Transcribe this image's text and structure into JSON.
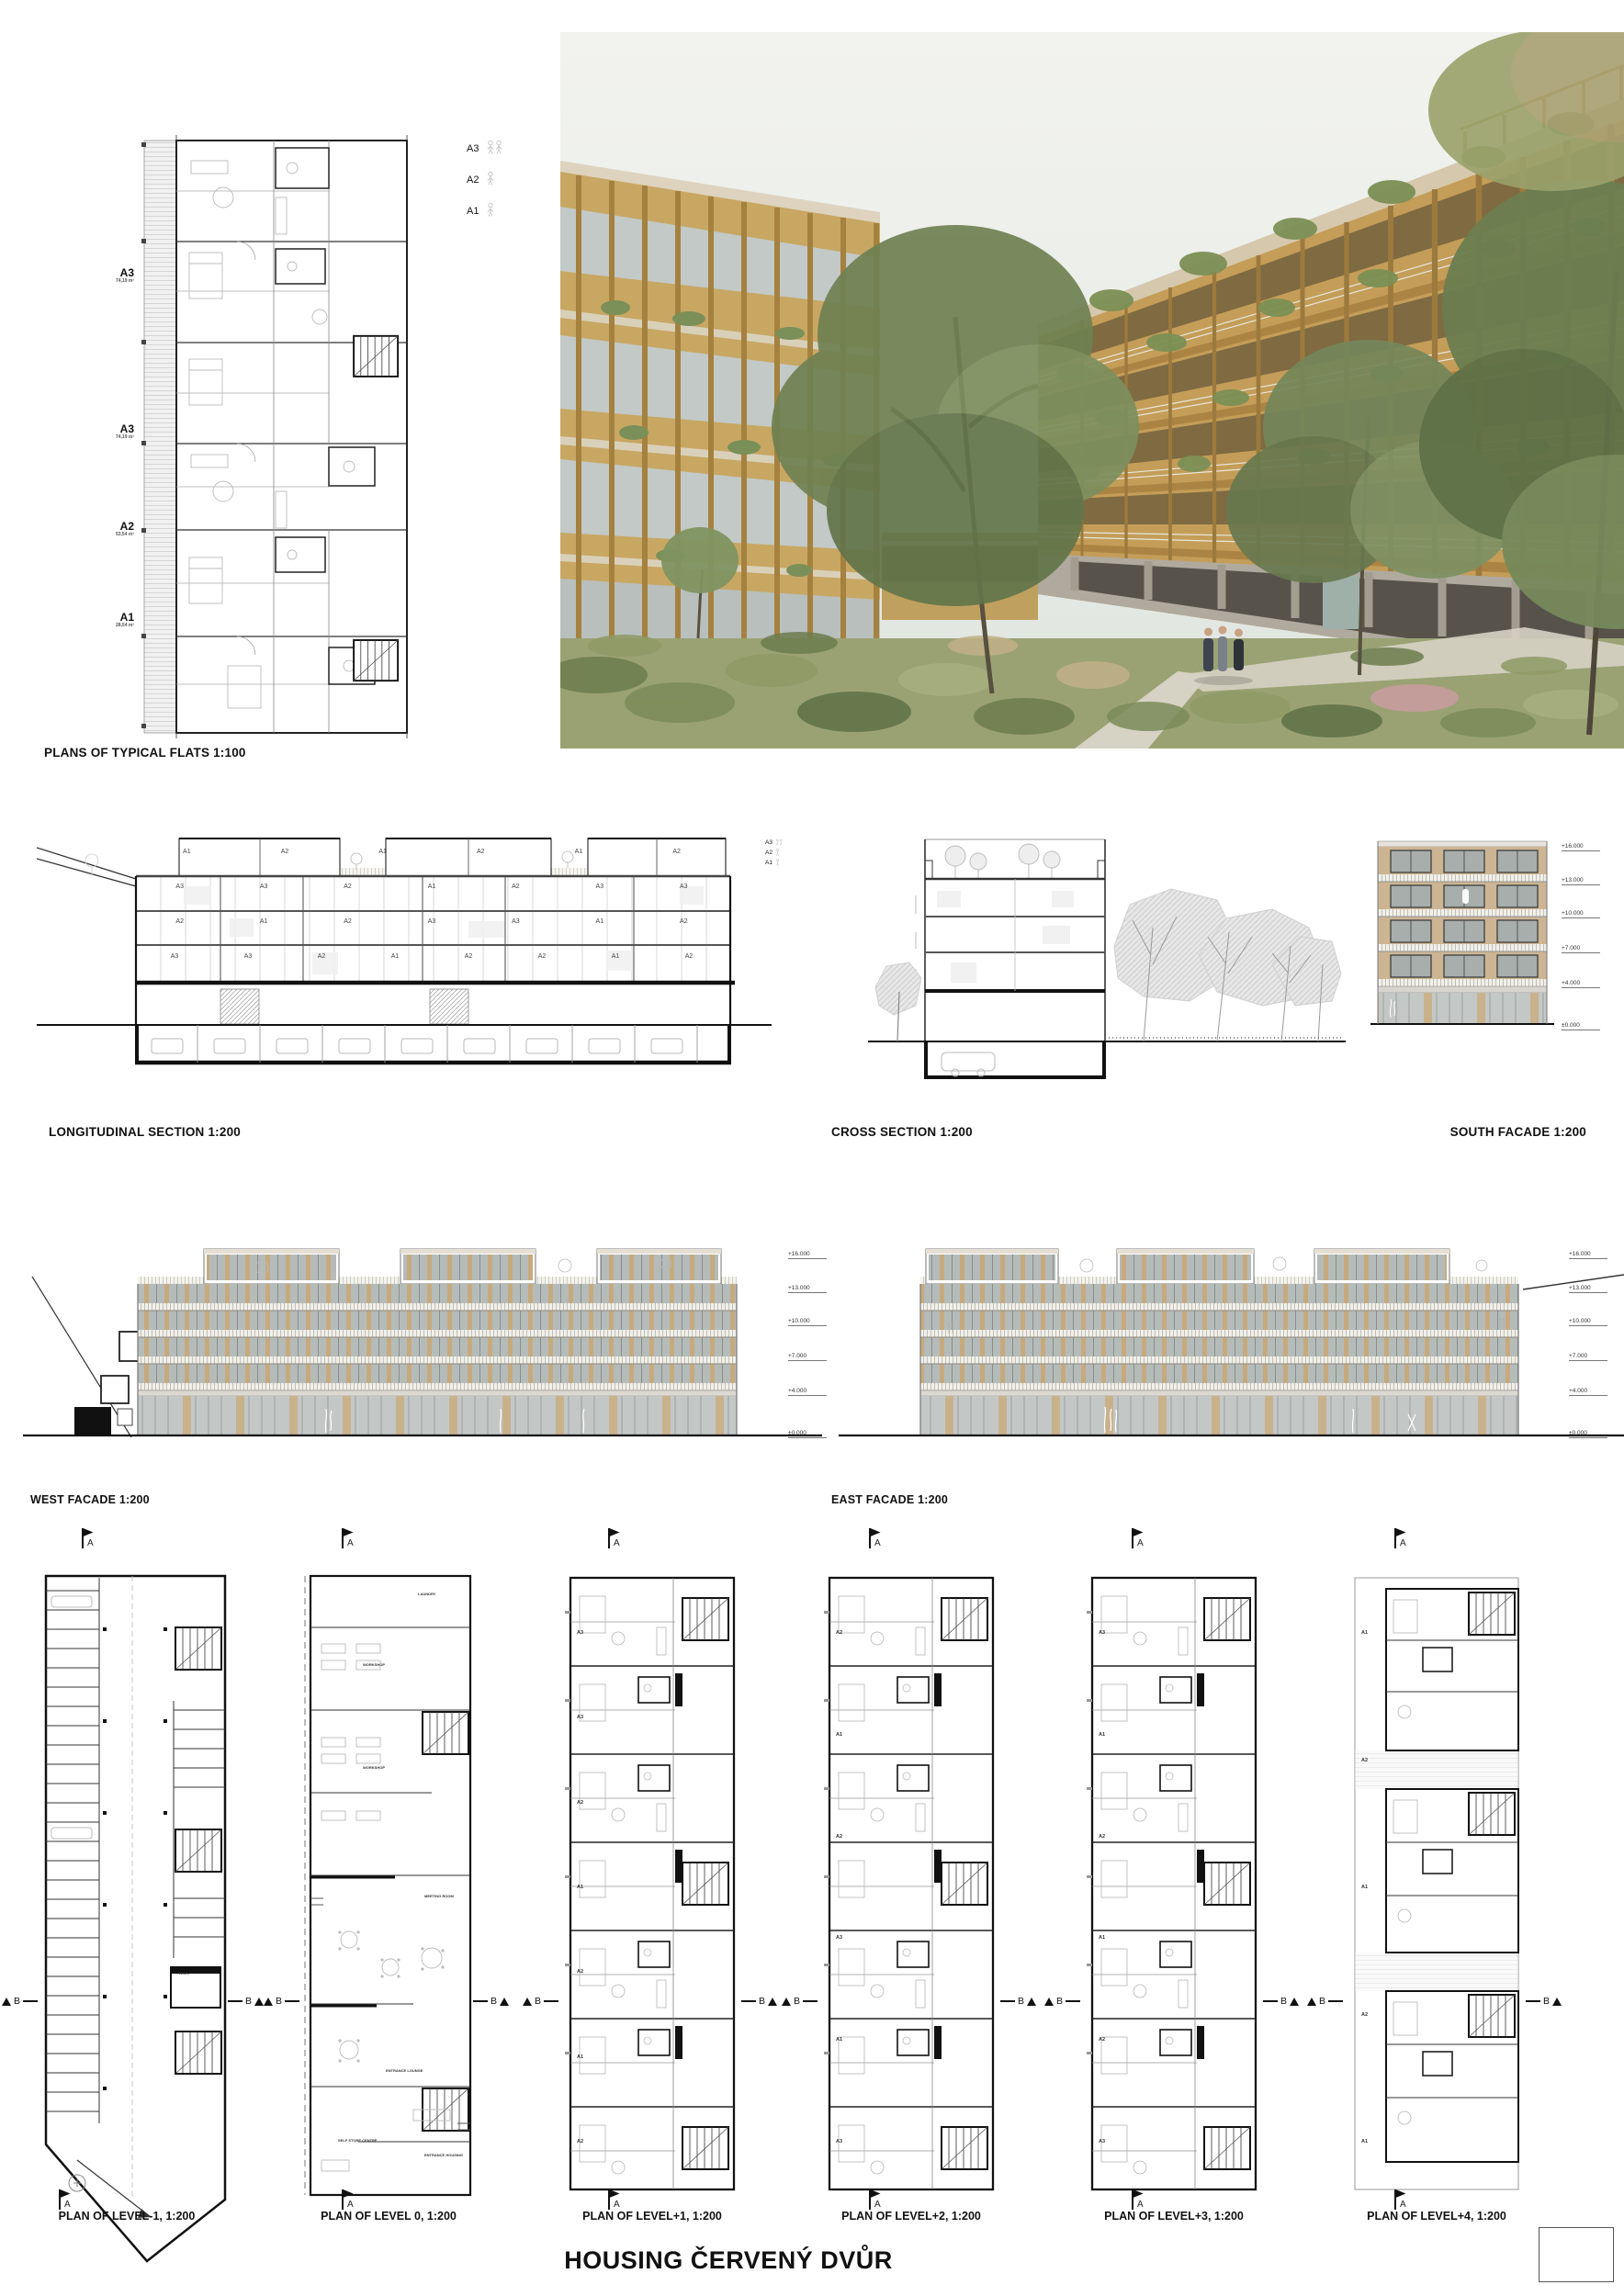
{
  "board": {
    "title": "HOUSING ČERVENÝ DVŮR"
  },
  "typical_flats": {
    "title": "PLANS OF TYPICAL FLATS 1:100",
    "unit_labels": [
      {
        "name": "A3",
        "area": "74,19 m²"
      },
      {
        "name": "A3",
        "area": "74,19 m²"
      },
      {
        "name": "A2",
        "area": "53,54 m²"
      },
      {
        "name": "A1",
        "area": "28,54 m²"
      }
    ],
    "legend": [
      {
        "label": "A3",
        "occupancy": "2 persons"
      },
      {
        "label": "A2",
        "occupancy": "1 person"
      },
      {
        "label": "A1",
        "occupancy": "1 person"
      }
    ]
  },
  "sections": {
    "longitudinal": {
      "title": "LONGITUDINAL SECTION 1:200",
      "legend": [
        "A3",
        "A2",
        "A1"
      ],
      "floor_units": [
        [
          "A1",
          "A2",
          "A1",
          "A2",
          "A1",
          "A2"
        ],
        [
          "A3",
          "A3",
          "A2",
          "A1",
          "A2",
          "A3",
          "A3"
        ],
        [
          "A2",
          "A1",
          "A2",
          "A3",
          "A3",
          "A1",
          "A2"
        ],
        [
          "A3",
          "A3",
          "A2",
          "A1",
          "A2",
          "A2",
          "A1",
          "A2"
        ]
      ]
    },
    "cross": {
      "title": "CROSS SECTION 1:200"
    }
  },
  "facades": {
    "south": {
      "title": "SOUTH FACADE 1:200",
      "levels": [
        "+16.000",
        "+13.000",
        "+10.000",
        "+7.000",
        "+4.000",
        "±0.000"
      ]
    },
    "west": {
      "title": "WEST FACADE 1:200",
      "levels": [
        "+16.000",
        "+13.000",
        "+10.000",
        "+7.000",
        "+4.000",
        "±0.000"
      ]
    },
    "east": {
      "title": "EAST FACADE 1:200",
      "levels": [
        "+16.000",
        "+13.000",
        "+10.000",
        "+7.000",
        "+4.000",
        "±0.000"
      ]
    }
  },
  "plans": {
    "marker_a": "A",
    "marker_b": "B",
    "items": [
      {
        "title": "PLAN OF LEVEL-1, 1:200",
        "rooms": [
          "TECH."
        ]
      },
      {
        "title": "PLAN OF LEVEL 0, 1:200",
        "rooms": [
          "LAUNDRY",
          "WORKSHOP",
          "WORKSHOP",
          "MEETING ROOM",
          "ENTRANCE LOUNGE",
          "SELF STORE CENTRE",
          "ENTRANCE HOUSING"
        ]
      },
      {
        "title": "PLAN OF LEVEL+1, 1:200",
        "units": [
          "A3",
          "A3",
          "A2",
          "A1",
          "A2",
          "A1",
          "A2"
        ]
      },
      {
        "title": "PLAN OF LEVEL+2, 1:200",
        "units": [
          "A2",
          "A1",
          "A2",
          "A3",
          "A1",
          "A3"
        ]
      },
      {
        "title": "PLAN OF LEVEL+3, 1:200",
        "units": [
          "A3",
          "A1",
          "A2",
          "A1",
          "A2",
          "A3"
        ]
      },
      {
        "title": "PLAN OF LEVEL+4, 1:200",
        "units": [
          "A1",
          "A2",
          "A1",
          "A2",
          "A1"
        ]
      }
    ]
  },
  "colors": {
    "timber": "#c49d58",
    "facade_beige": "#cdb593",
    "glazing": "#aab1af",
    "foliage": "#74875a",
    "concrete": "#b0aa9e",
    "line": "#1a1a1a"
  }
}
